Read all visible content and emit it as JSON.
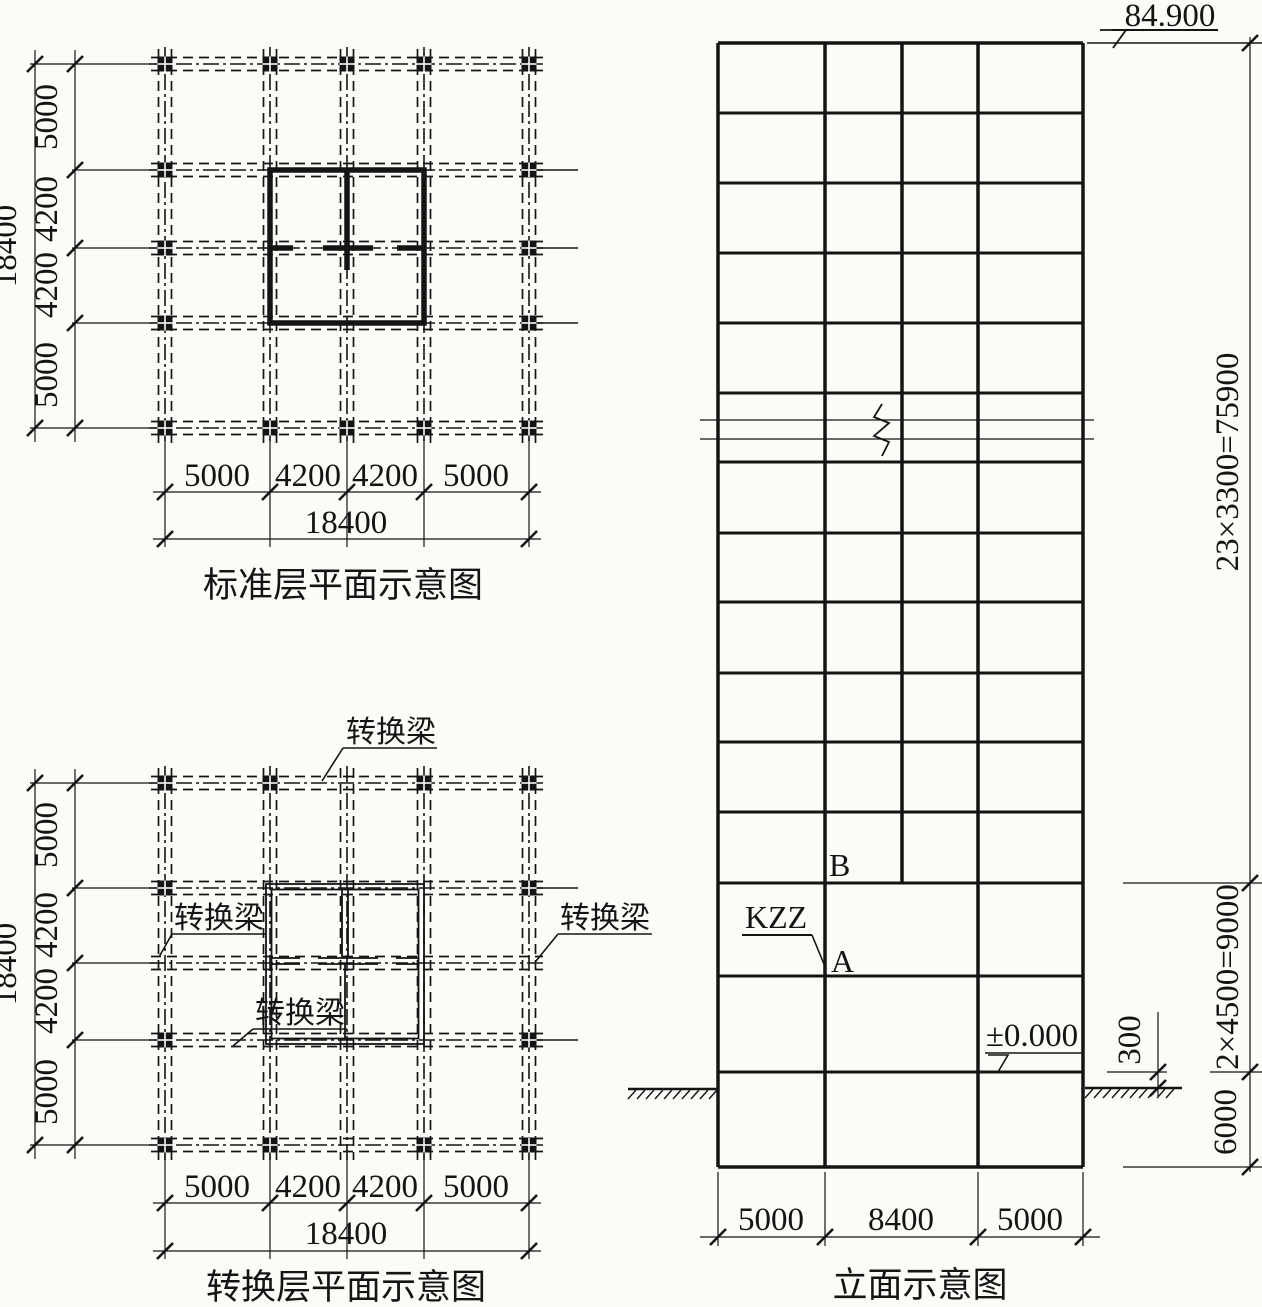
{
  "plan_top": {
    "title": "标准层平面示意图",
    "dim_total_left": "18400",
    "dims_left": [
      "5000",
      "4200",
      "4200",
      "5000"
    ],
    "dims_bottom": [
      "5000",
      "4200",
      "4200",
      "5000"
    ],
    "dim_total_bottom": "18400"
  },
  "plan_transfer": {
    "title": "转换层平面示意图",
    "dim_total_left": "18400",
    "dims_left": [
      "5000",
      "4200",
      "4200",
      "5000"
    ],
    "dims_bottom": [
      "5000",
      "4200",
      "4200",
      "5000"
    ],
    "dim_total_bottom": "18400",
    "beam_label_top": "转换梁",
    "beam_label_left": "转换梁",
    "beam_label_right": "转换梁",
    "beam_label_bottom": "转换梁"
  },
  "elevation": {
    "title": "立面示意图",
    "roof_level": "84.900",
    "ground_level": "±0.000",
    "dim_tower": "23×3300=75900",
    "dim_transfer_storeys": "2×4500=9000",
    "dim_ground_offset": "300",
    "dim_basement": "6000",
    "dims_bottom": [
      "5000",
      "8400",
      "5000"
    ],
    "label_kzz": "KZZ",
    "label_a": "A",
    "label_b": "B"
  }
}
